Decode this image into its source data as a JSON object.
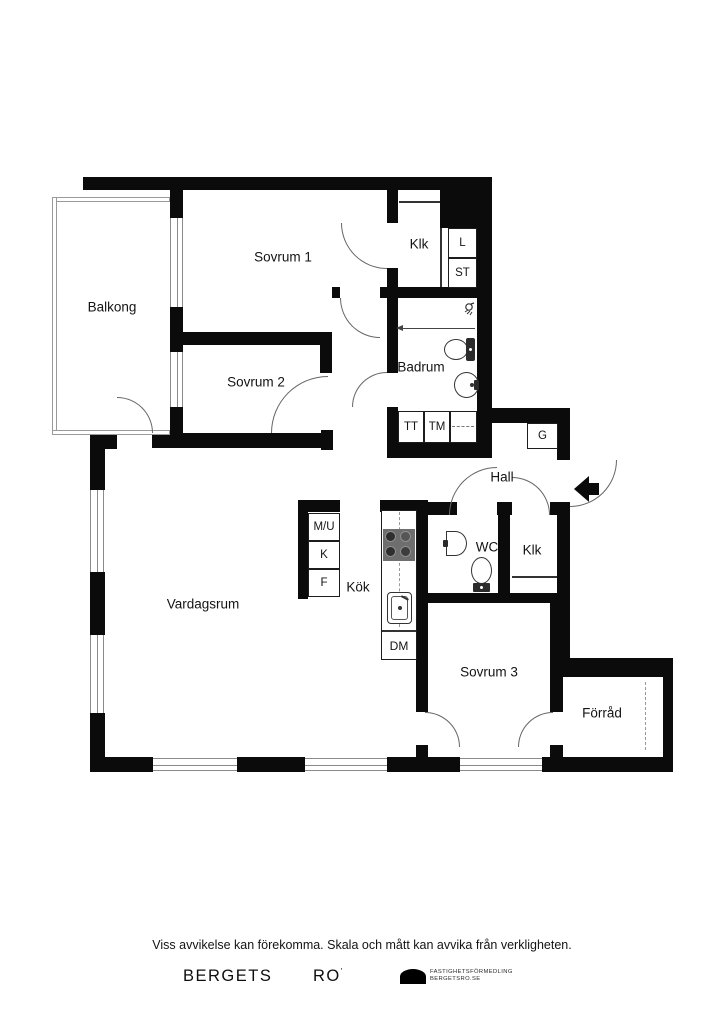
{
  "floorplan": {
    "rooms": {
      "balkong": "Balkong",
      "sovrum1": "Sovrum 1",
      "sovrum2": "Sovrum 2",
      "klk1": "Klk",
      "badrum": "Badrum",
      "hall": "Hall",
      "vardagsrum": "Vardagsrum",
      "kok": "Kök",
      "wc": "WC",
      "klk2": "Klk",
      "sovrum3": "Sovrum 3",
      "forrad": "Förråd"
    },
    "cells": {
      "l": "L",
      "st": "ST",
      "tt": "TT",
      "tm": "TM",
      "g": "G",
      "mu": "M/U",
      "k": "K",
      "f": "F",
      "dm": "DM"
    },
    "colors": {
      "wall": "#0b0b0b",
      "door_arc": "#666666",
      "window_line": "#8a8a8a",
      "fixture_line": "#333333"
    }
  },
  "footer": {
    "disclaimer": "Viss avvikelse kan förekomma. Skala och mått kan avvika från verkligheten.",
    "brand_left": "BERGETS",
    "brand_right": "RO",
    "brand_mark": "'",
    "agency_line1": "FASTIGHETSFÖRMEDLING",
    "agency_line2": "BERGETSRO.SE"
  }
}
